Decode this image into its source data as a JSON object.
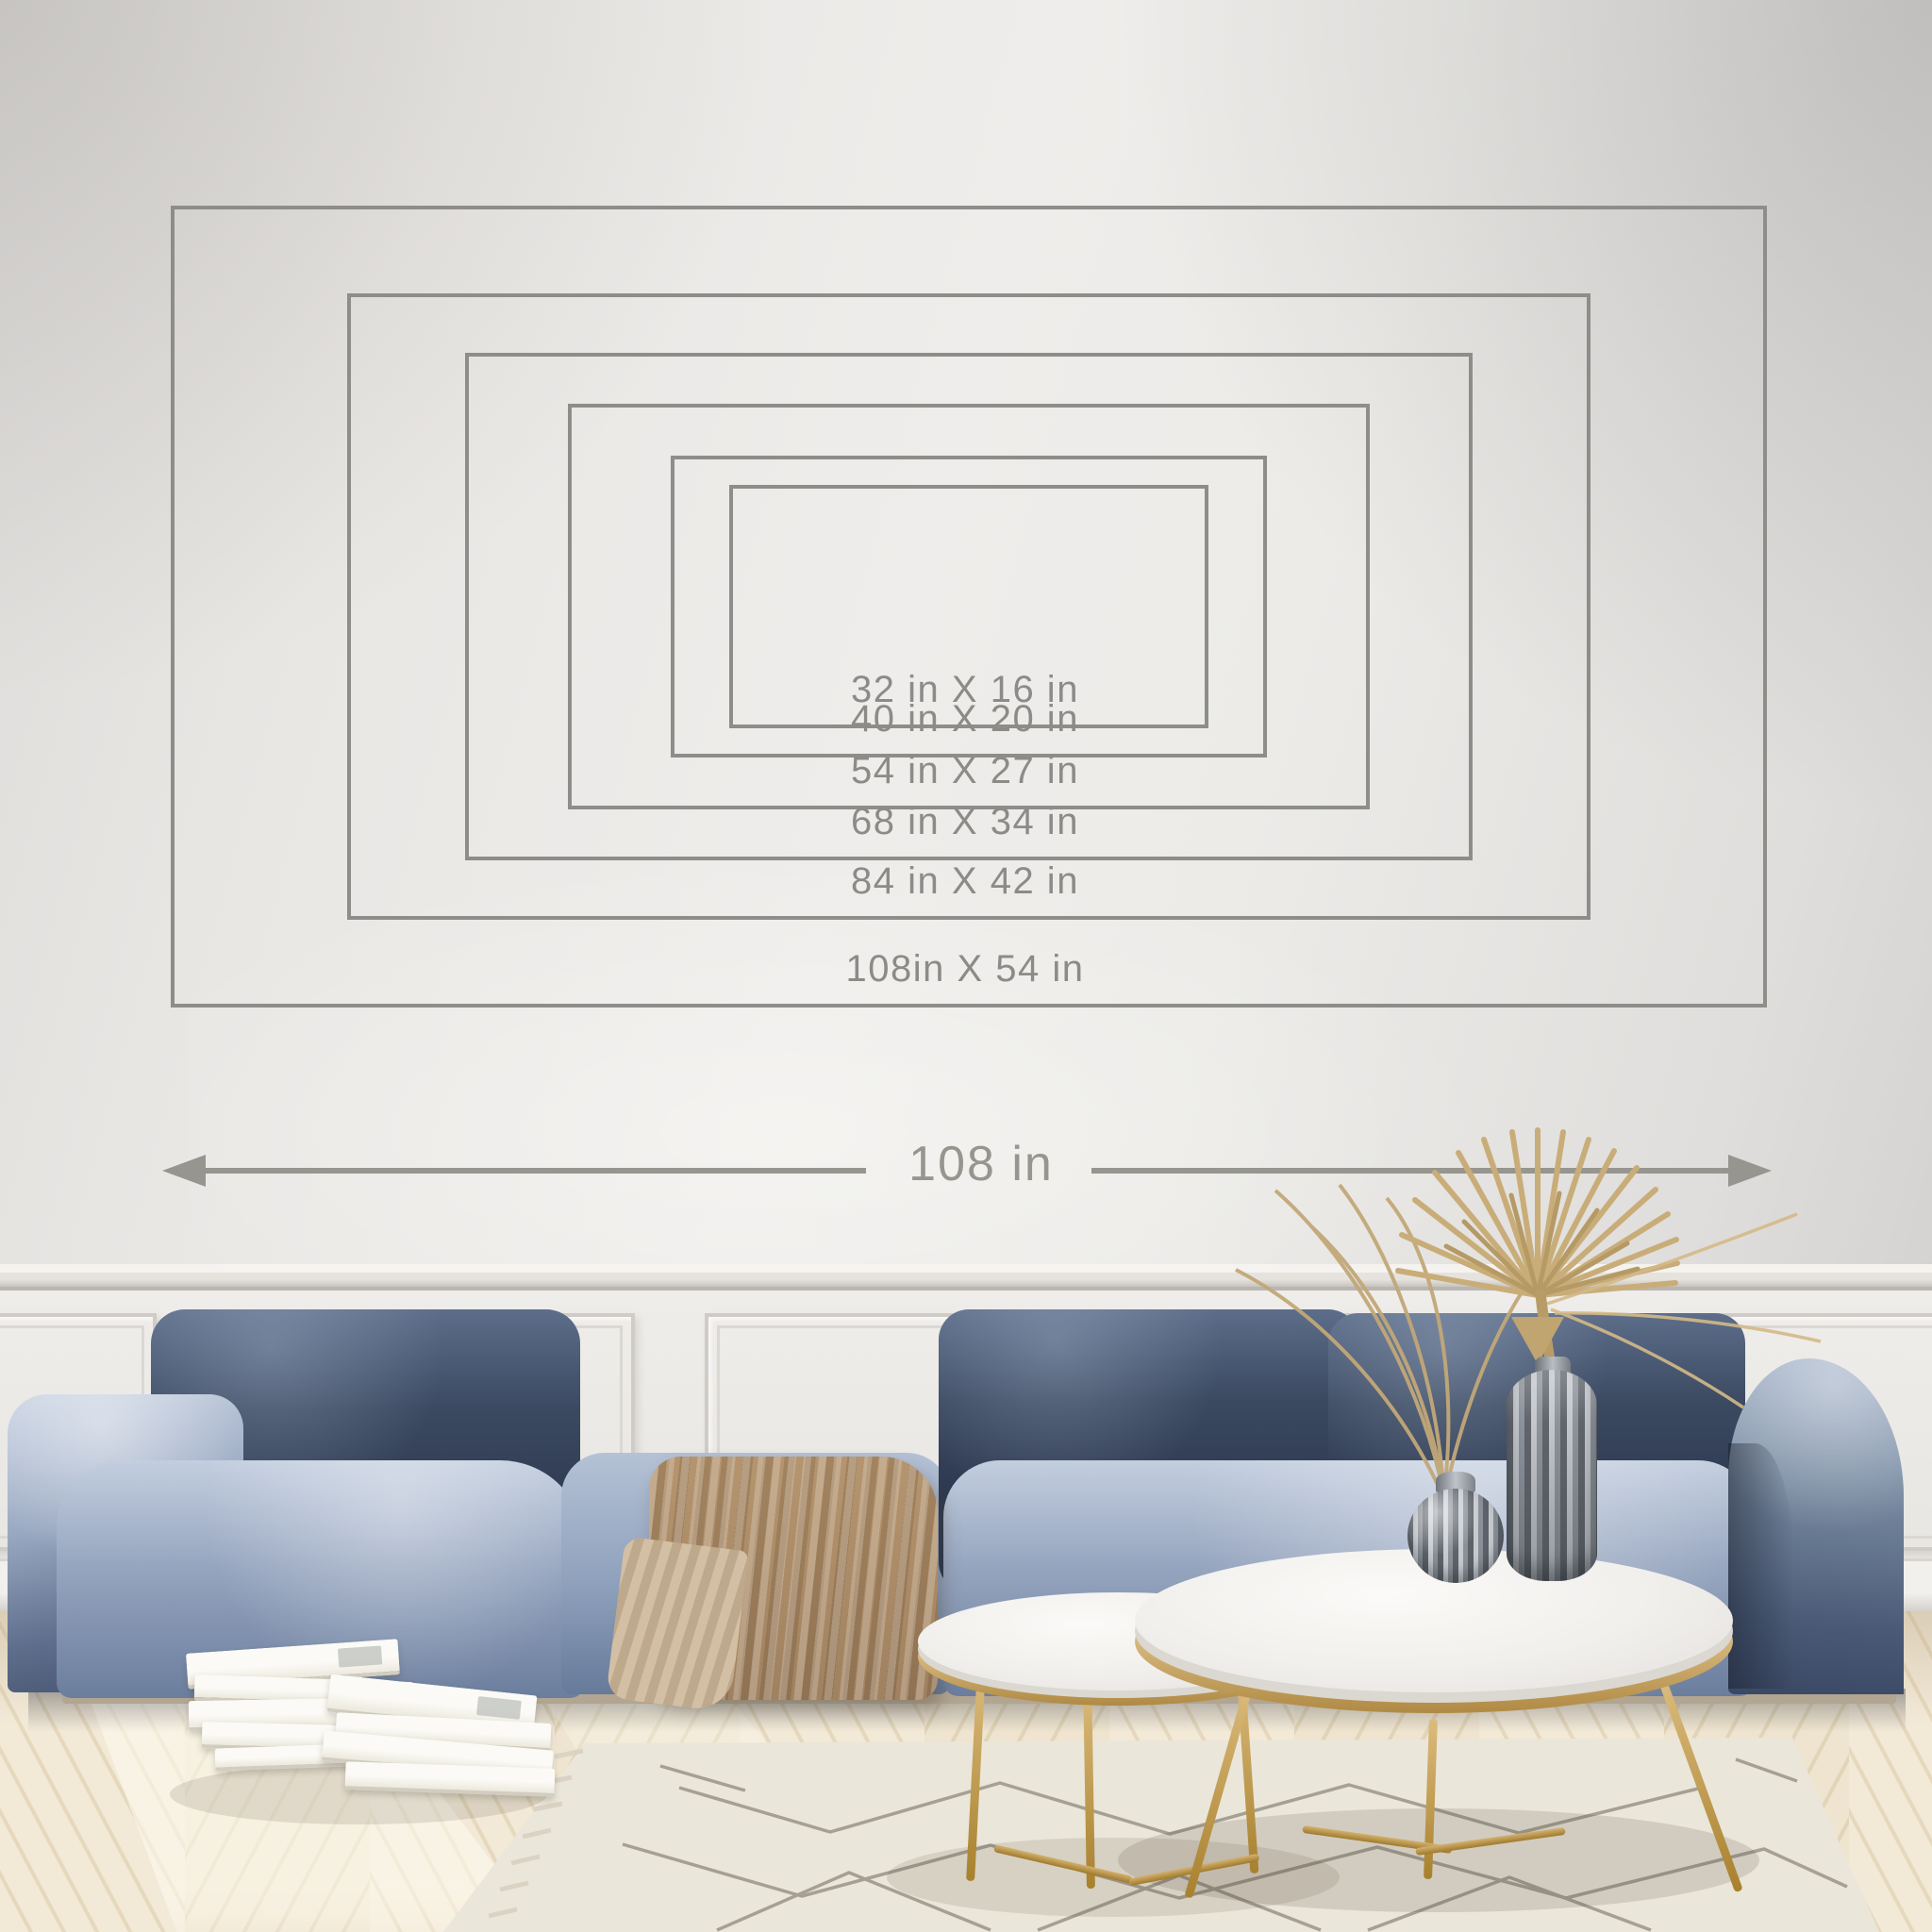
{
  "size_guide": {
    "unit_label": "in",
    "sizes": [
      {
        "label": "32 in X 16 in",
        "width_in": 32,
        "height_in": 16
      },
      {
        "label": "40 in X 20 in",
        "width_in": 40,
        "height_in": 20
      },
      {
        "label": "54 in X 27 in",
        "width_in": 54,
        "height_in": 27
      },
      {
        "label": "68 in X 34 in",
        "width_in": 68,
        "height_in": 34
      },
      {
        "label": "84 in X 42 in",
        "width_in": 84,
        "height_in": 42
      },
      {
        "label": "108in X 54 in",
        "width_in": 108,
        "height_in": 54
      }
    ],
    "width_arrow_label": "108 in",
    "line_color": "#8d8d8a",
    "label_color": "#8b8b88",
    "arrow_color": "#97958f"
  }
}
